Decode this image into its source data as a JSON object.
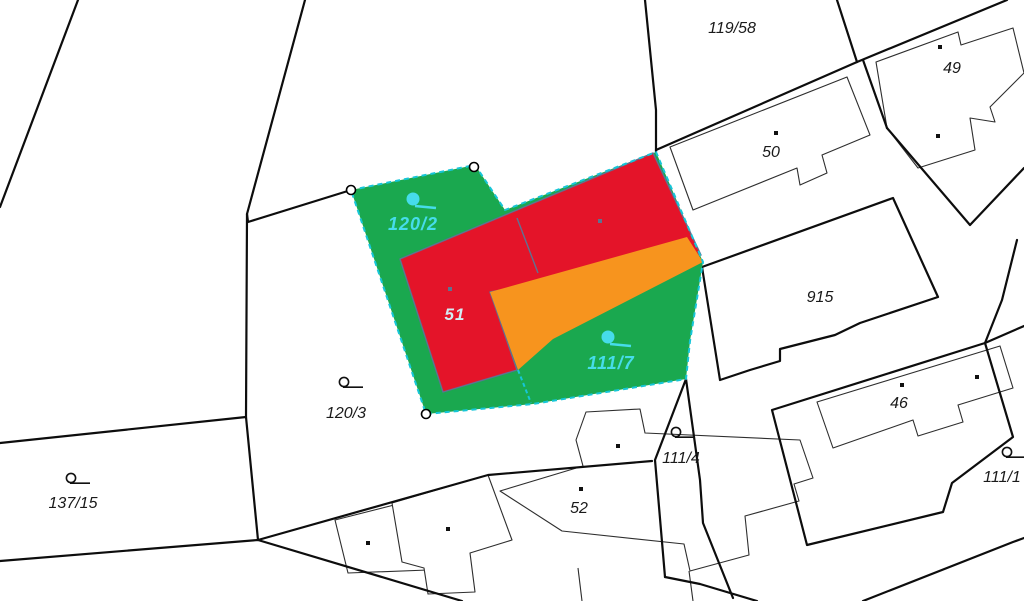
{
  "map": {
    "title": "cadastral-parcel-map",
    "canvas": {
      "width": 1024,
      "height": 601,
      "background": "#ffffff"
    },
    "colors": {
      "boundary": "#0d0d0d",
      "building_outline": "#2e2e2e",
      "building_fill": "#ffffff",
      "parcel_green": "#1aa84f",
      "parcel_red": "#e41429",
      "parcel_orange": "#f7941e",
      "selection_dash": "#16c6d8",
      "label_black": "#1a1a1a",
      "label_cyan": "#46dcea",
      "label_light": "#d3ecf3",
      "red_outline": "#5f7292",
      "dot_black": "#111111",
      "dot_slate": "#5d7390",
      "vertex_fill": "#ffffff",
      "vertex_stroke": "#000000"
    },
    "areas": [
      {
        "name": "parcel-green-selected",
        "fill": "parcel_green",
        "points": [
          [
            351,
            190
          ],
          [
            475,
            165
          ],
          [
            505,
            210
          ],
          [
            656,
            152
          ],
          [
            703,
            262
          ],
          [
            690,
            341
          ],
          [
            686,
            379
          ],
          [
            533,
            404
          ],
          [
            426,
            414
          ]
        ]
      },
      {
        "name": "building-51-red",
        "fill": "parcel_red",
        "stroke": "red_outline",
        "points": [
          [
            400,
            259
          ],
          [
            653,
            153
          ],
          [
            701,
            255
          ],
          [
            490,
            292
          ],
          [
            517,
            370
          ],
          [
            443,
            392
          ]
        ]
      },
      {
        "name": "building-extension-orange",
        "fill": "parcel_orange",
        "points": [
          [
            490,
            292
          ],
          [
            687,
            237
          ],
          [
            703,
            262
          ],
          [
            553,
            339
          ],
          [
            518,
            370
          ]
        ]
      }
    ],
    "selection_outline": {
      "name": "selected-parcel-outline",
      "points": [
        [
          351,
          190
        ],
        [
          475,
          165
        ],
        [
          505,
          210
        ],
        [
          656,
          152
        ],
        [
          703,
          262
        ],
        [
          690,
          341
        ],
        [
          686,
          379
        ],
        [
          533,
          404
        ],
        [
          426,
          414
        ]
      ]
    },
    "selection_divider": {
      "name": "selected-parcel-divider",
      "points": [
        [
          518,
          370
        ],
        [
          531,
          403
        ]
      ]
    },
    "red_divider": {
      "name": "red-building-divider",
      "points": [
        [
          517,
          218
        ],
        [
          538,
          273
        ]
      ]
    },
    "boundaries": [
      {
        "name": "boundary-topleft",
        "points": [
          [
            78,
            0
          ],
          [
            0,
            207
          ]
        ]
      },
      {
        "name": "boundary-120-3-top",
        "points": [
          [
            305,
            0
          ],
          [
            247,
            214
          ],
          [
            248,
            222
          ],
          [
            351,
            190
          ]
        ]
      },
      {
        "name": "boundary-120-3-left",
        "points": [
          [
            247,
            214
          ],
          [
            246,
            417
          ],
          [
            258,
            540
          ]
        ]
      },
      {
        "name": "boundary-137-15-top",
        "points": [
          [
            0,
            443
          ],
          [
            246,
            417
          ]
        ]
      },
      {
        "name": "boundary-137-15-bottom",
        "points": [
          [
            0,
            561
          ],
          [
            258,
            540
          ]
        ]
      },
      {
        "name": "boundary-bottom-left-diag",
        "points": [
          [
            258,
            540
          ],
          [
            462,
            601
          ]
        ]
      },
      {
        "name": "boundary-above-52",
        "points": [
          [
            258,
            540
          ],
          [
            488,
            475
          ],
          [
            652,
            461
          ]
        ]
      },
      {
        "name": "boundary-path-left",
        "points": [
          [
            686,
            379
          ],
          [
            655,
            460
          ],
          [
            665,
            577
          ]
        ]
      },
      {
        "name": "boundary-path-right",
        "points": [
          [
            686,
            379
          ],
          [
            700,
            480
          ],
          [
            703,
            523
          ],
          [
            733,
            598
          ]
        ]
      },
      {
        "name": "boundary-path-bottom",
        "points": [
          [
            665,
            577
          ],
          [
            700,
            584
          ],
          [
            757,
            601
          ]
        ]
      },
      {
        "name": "boundary-119-58-right",
        "points": [
          [
            645,
            0
          ],
          [
            656,
            110
          ],
          [
            656,
            152
          ]
        ]
      },
      {
        "name": "boundary-50-top",
        "points": [
          [
            656,
            150
          ],
          [
            857,
            62
          ]
        ]
      },
      {
        "name": "boundary-119-58-corner",
        "points": [
          [
            837,
            0
          ],
          [
            857,
            62
          ]
        ]
      },
      {
        "name": "boundary-topright",
        "points": [
          [
            857,
            62
          ],
          [
            1007,
            0
          ]
        ]
      },
      {
        "name": "boundary-49-left",
        "points": [
          [
            863,
            60
          ],
          [
            887,
            128
          ]
        ]
      },
      {
        "name": "boundary-49-v",
        "points": [
          [
            887,
            128
          ],
          [
            970,
            225
          ],
          [
            1024,
            168
          ]
        ]
      },
      {
        "name": "boundary-915",
        "closed": true,
        "points": [
          [
            702,
            267
          ],
          [
            893,
            198
          ],
          [
            938,
            297
          ],
          [
            860,
            323
          ],
          [
            835,
            335
          ],
          [
            780,
            349
          ],
          [
            780,
            361
          ],
          [
            750,
            370
          ],
          [
            720,
            380
          ]
        ]
      },
      {
        "name": "boundary-right-notch",
        "points": [
          [
            1017,
            240
          ],
          [
            1002,
            300
          ],
          [
            985,
            343
          ]
        ]
      },
      {
        "name": "boundary-46",
        "closed": true,
        "points": [
          [
            772,
            410
          ],
          [
            985,
            343
          ],
          [
            1013,
            437
          ],
          [
            952,
            483
          ],
          [
            943,
            512
          ],
          [
            807,
            545
          ]
        ]
      },
      {
        "name": "boundary-bottom-right-diag",
        "points": [
          [
            863,
            601
          ],
          [
            1013,
            542
          ],
          [
            1024,
            538
          ]
        ]
      },
      {
        "name": "boundary-right-edge",
        "points": [
          [
            985,
            343
          ],
          [
            1024,
            326
          ]
        ]
      }
    ],
    "buildings": [
      {
        "name": "building-50",
        "points": [
          [
            670,
            147
          ],
          [
            847,
            77
          ],
          [
            870,
            135
          ],
          [
            822,
            155
          ],
          [
            827,
            173
          ],
          [
            800,
            185
          ],
          [
            797,
            168
          ],
          [
            693,
            210
          ]
        ]
      },
      {
        "name": "building-49",
        "points": [
          [
            876,
            62
          ],
          [
            958,
            32
          ],
          [
            961,
            45
          ],
          [
            1013,
            28
          ],
          [
            1024,
            73
          ],
          [
            990,
            107
          ],
          [
            995,
            122
          ],
          [
            970,
            118
          ],
          [
            975,
            150
          ],
          [
            918,
            168
          ],
          [
            887,
            128
          ]
        ]
      },
      {
        "name": "building-46",
        "points": [
          [
            817,
            402
          ],
          [
            1000,
            346
          ],
          [
            1013,
            388
          ],
          [
            958,
            405
          ],
          [
            963,
            422
          ],
          [
            918,
            436
          ],
          [
            913,
            420
          ],
          [
            833,
            448
          ]
        ]
      },
      {
        "name": "building-52-west",
        "points": [
          [
            335,
            520
          ],
          [
            402,
            503
          ],
          [
            428,
            570
          ],
          [
            348,
            573
          ]
        ]
      },
      {
        "name": "building-52-mid",
        "points": [
          [
            392,
            503
          ],
          [
            488,
            475
          ],
          [
            512,
            540
          ],
          [
            470,
            553
          ],
          [
            475,
            592
          ],
          [
            428,
            594
          ],
          [
            424,
            568
          ],
          [
            402,
            562
          ]
        ]
      },
      {
        "name": "building-52-main",
        "points": [
          [
            500,
            491
          ],
          [
            583,
            466
          ],
          [
            576,
            440
          ],
          [
            586,
            412
          ],
          [
            640,
            409
          ],
          [
            645,
            433
          ],
          [
            800,
            440
          ],
          [
            813,
            478
          ],
          [
            794,
            484
          ],
          [
            799,
            501
          ],
          [
            745,
            516
          ],
          [
            749,
            555
          ],
          [
            690,
            571
          ],
          [
            684,
            544
          ],
          [
            562,
            531
          ]
        ]
      }
    ],
    "annex_lines": [
      {
        "name": "building-52-annex-left",
        "points": [
          [
            578,
            568
          ],
          [
            582,
            601
          ]
        ]
      },
      {
        "name": "building-52-annex-right",
        "points": [
          [
            689,
            571
          ],
          [
            693,
            601
          ]
        ]
      }
    ],
    "labels": [
      {
        "name": "parcel-label-119-58",
        "text": "119/58",
        "x": 732,
        "y": 33,
        "style": "black"
      },
      {
        "name": "building-label-50",
        "text": "50",
        "x": 771,
        "y": 157,
        "style": "black"
      },
      {
        "name": "building-label-49",
        "text": "49",
        "x": 952,
        "y": 73,
        "style": "black"
      },
      {
        "name": "parcel-label-915",
        "text": "915",
        "x": 820,
        "y": 302,
        "style": "black"
      },
      {
        "name": "building-label-46",
        "text": "46",
        "x": 899,
        "y": 408,
        "style": "black"
      },
      {
        "name": "building-label-52",
        "text": "52",
        "x": 579,
        "y": 513,
        "style": "black"
      },
      {
        "name": "parcel-label-120-3",
        "text": "120/3",
        "x": 346,
        "y": 418,
        "style": "black"
      },
      {
        "name": "parcel-label-137-15",
        "text": "137/15",
        "x": 73,
        "y": 508,
        "style": "black"
      },
      {
        "name": "parcel-label-111-4",
        "text": "111/4",
        "x": 681,
        "y": 463,
        "style": "black"
      },
      {
        "name": "parcel-label-111-x",
        "text": "111/1",
        "x": 1002,
        "y": 482,
        "style": "black"
      },
      {
        "name": "parcel-label-120-2",
        "text": "120/2",
        "x": 413,
        "y": 230,
        "style": "cyan"
      },
      {
        "name": "parcel-label-111-7",
        "text": "111/7",
        "x": 611,
        "y": 369,
        "style": "cyan"
      },
      {
        "name": "building-label-51",
        "text": "51",
        "x": 455,
        "y": 320,
        "style": "light"
      }
    ],
    "loop_symbols": [
      {
        "name": "parcel-link-icon-120-3",
        "x": 344,
        "y": 382,
        "color": "black"
      },
      {
        "name": "parcel-link-icon-137-15",
        "x": 71,
        "y": 478,
        "color": "black"
      },
      {
        "name": "parcel-link-icon-111-4",
        "x": 676,
        "y": 432,
        "color": "black"
      },
      {
        "name": "parcel-link-icon-111-x",
        "x": 1007,
        "y": 452,
        "color": "black"
      },
      {
        "name": "parcel-link-icon-120-2",
        "x": 413,
        "y": 199,
        "color": "cyan"
      },
      {
        "name": "parcel-link-icon-111-7",
        "x": 608,
        "y": 337,
        "color": "cyan"
      }
    ],
    "vertex_markers": [
      {
        "name": "vertex-marker",
        "x": 351,
        "y": 190
      },
      {
        "name": "vertex-marker",
        "x": 474,
        "y": 167
      },
      {
        "name": "vertex-marker",
        "x": 426,
        "y": 414
      }
    ],
    "building_dots": [
      {
        "x": 776,
        "y": 133,
        "color": "black"
      },
      {
        "x": 940,
        "y": 47,
        "color": "black"
      },
      {
        "x": 938,
        "y": 136,
        "color": "black"
      },
      {
        "x": 902,
        "y": 385,
        "color": "black"
      },
      {
        "x": 977,
        "y": 377,
        "color": "black"
      },
      {
        "x": 581,
        "y": 489,
        "color": "black"
      },
      {
        "x": 368,
        "y": 543,
        "color": "black"
      },
      {
        "x": 448,
        "y": 529,
        "color": "black"
      },
      {
        "x": 618,
        "y": 446,
        "color": "black"
      },
      {
        "x": 600,
        "y": 221,
        "color": "slate"
      },
      {
        "x": 450,
        "y": 289,
        "color": "slate"
      }
    ]
  }
}
